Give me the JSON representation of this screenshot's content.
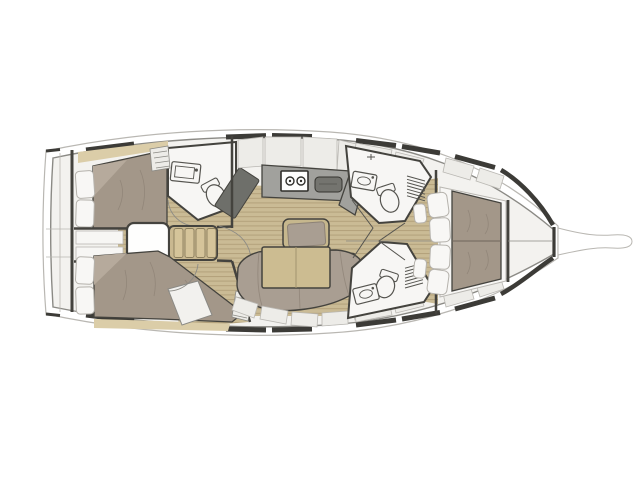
{
  "diagram": {
    "type": "yacht-interior-floor-plan",
    "orientation": "bow-right-stern-left",
    "regions": [
      {
        "id": "aft-cabin-port",
        "fixtures": [
          "double-bed",
          "pillows",
          "wood-trim"
        ]
      },
      {
        "id": "aft-cabin-starboard",
        "fixtures": [
          "double-bed",
          "pillows",
          "wardrobe",
          "louver-locker"
        ]
      },
      {
        "id": "aft-head",
        "fixtures": [
          "washbasin",
          "toilet",
          "shower-panel",
          "louver-locker"
        ]
      },
      {
        "id": "galley",
        "fixtures": [
          "counter",
          "two-burner-stove",
          "sink",
          "lockers",
          "dark-cabinet"
        ]
      },
      {
        "id": "salon",
        "fixtures": [
          "c-shaped-sofa",
          "folding-table",
          "bench-seat",
          "seat-lockers"
        ]
      },
      {
        "id": "companionway",
        "fixtures": [
          "stairs",
          "engine-box",
          "berth-lockers"
        ]
      },
      {
        "id": "forward-head-port",
        "fixtures": [
          "toilet",
          "washbasin",
          "shelf-ladder"
        ]
      },
      {
        "id": "forward-head-starboard",
        "fixtures": [
          "toilet",
          "washbasin",
          "shelf-ladder"
        ]
      },
      {
        "id": "forward-cabin",
        "fixtures": [
          "double-bed",
          "pillows",
          "hull-lockers"
        ]
      },
      {
        "id": "anchor-locker",
        "fixtures": []
      },
      {
        "id": "bow-sprit",
        "fixtures": []
      }
    ]
  },
  "colors": {
    "background": "#ffffff",
    "hull_fill": "#f3f2ef",
    "outline_thin": "#b9b7b2",
    "outline_mid": "#8b8a85",
    "outline_dark": "#44433e",
    "window_dark": "#3c3b37",
    "wood_floor": "#cabb95",
    "wood_plank": "#b3a17b",
    "wood_trim": "#dbcda8",
    "bed": "#a39789",
    "bed_fold": "#b6aa9c",
    "pillow": "#f8f7f5",
    "pillow_stroke": "#b5b2ac",
    "sofa": "#a99e92",
    "counter": "#a1a19d",
    "sink_dark": "#74746f",
    "dark_panel": "#6e6f6a",
    "table_wood": "#ccbc91",
    "stairs_wood": "#c9b890",
    "stair_tread": "#d5c49a",
    "bench_wood": "#c6b78d",
    "locker": "#edece8",
    "fixture_white": "#f7f6f4"
  }
}
